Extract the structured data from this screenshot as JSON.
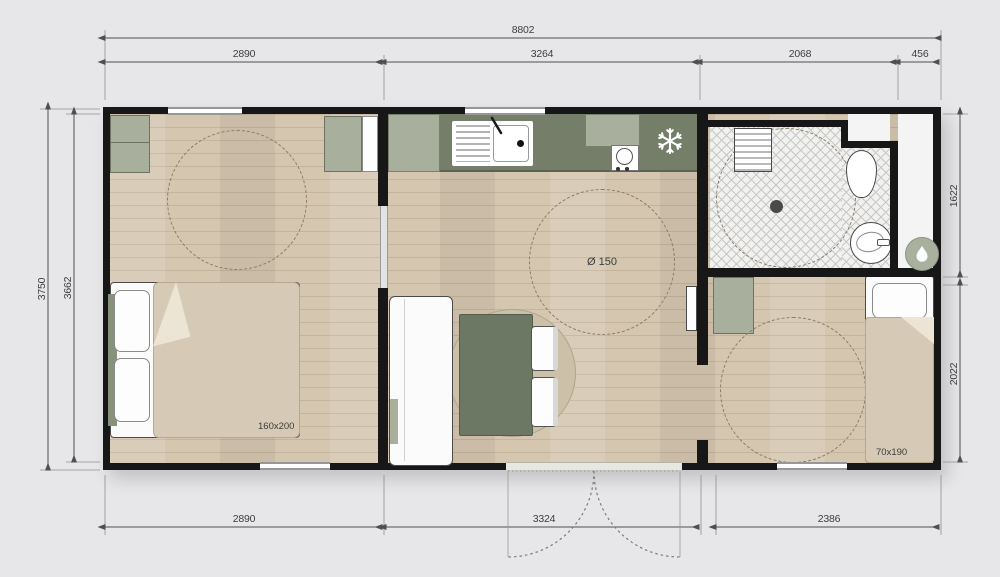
{
  "dimensions": {
    "top_overall": "8802",
    "top_segments": [
      "2890",
      "3264",
      "2068",
      "456"
    ],
    "bottom_segments": [
      "2890",
      "3324",
      "2386"
    ],
    "left": [
      "3750",
      "3662"
    ],
    "right": [
      "1622",
      "2022"
    ]
  },
  "labels": {
    "double_bed_size": "160x200",
    "single_bed_size": "70x190",
    "turning_circle_diameter": "Ø 150"
  },
  "rooms": {
    "bedroom_main": "double bedroom",
    "bedroom_single": "single bedroom",
    "kitchen": "kitchen",
    "living": "living-dining area",
    "bathroom": "shower room",
    "technical": "water-heater closet"
  },
  "colors": {
    "background": "#e7e7e9",
    "wall": "#171717",
    "floor_wood": "#d5c6b0",
    "cabinet_sage": "#a8b09d",
    "counter_dark_sage": "#747e69",
    "textile_beige": "#d6cab6",
    "tile": "#f1f1f0",
    "dimension_line": "#4f4f4f"
  }
}
